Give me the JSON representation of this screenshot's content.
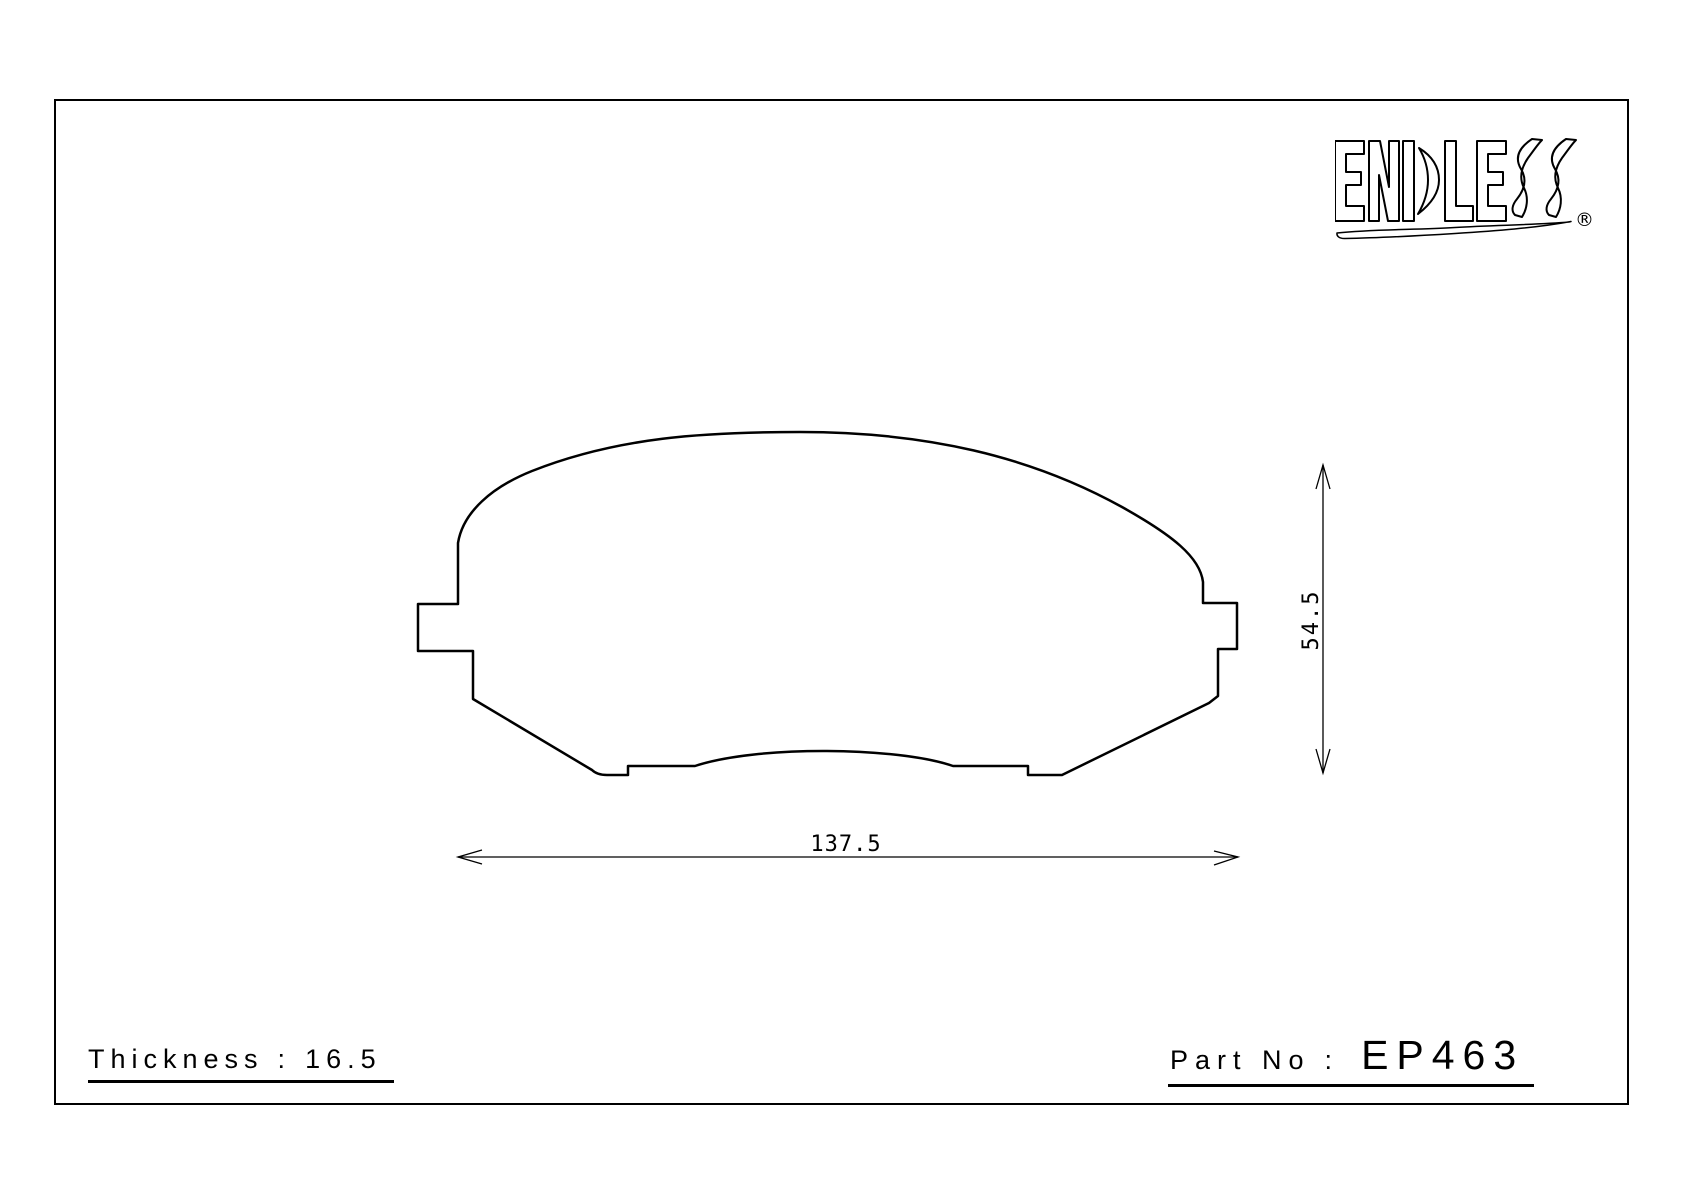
{
  "page": {
    "background_color": "#ffffff",
    "line_color": "#000000"
  },
  "brand": {
    "logo_text": "ENDLESS",
    "registered_mark": "®"
  },
  "drawing": {
    "shape": "brake-pad-outline",
    "width_dimension": {
      "value": "137.5"
    },
    "height_dimension": {
      "value": "54.5"
    }
  },
  "footer": {
    "thickness": {
      "label": "Thickness",
      "separator": ":",
      "value": "16.5"
    },
    "part": {
      "label": "Part No",
      "separator": ":",
      "value": "EP463"
    }
  }
}
